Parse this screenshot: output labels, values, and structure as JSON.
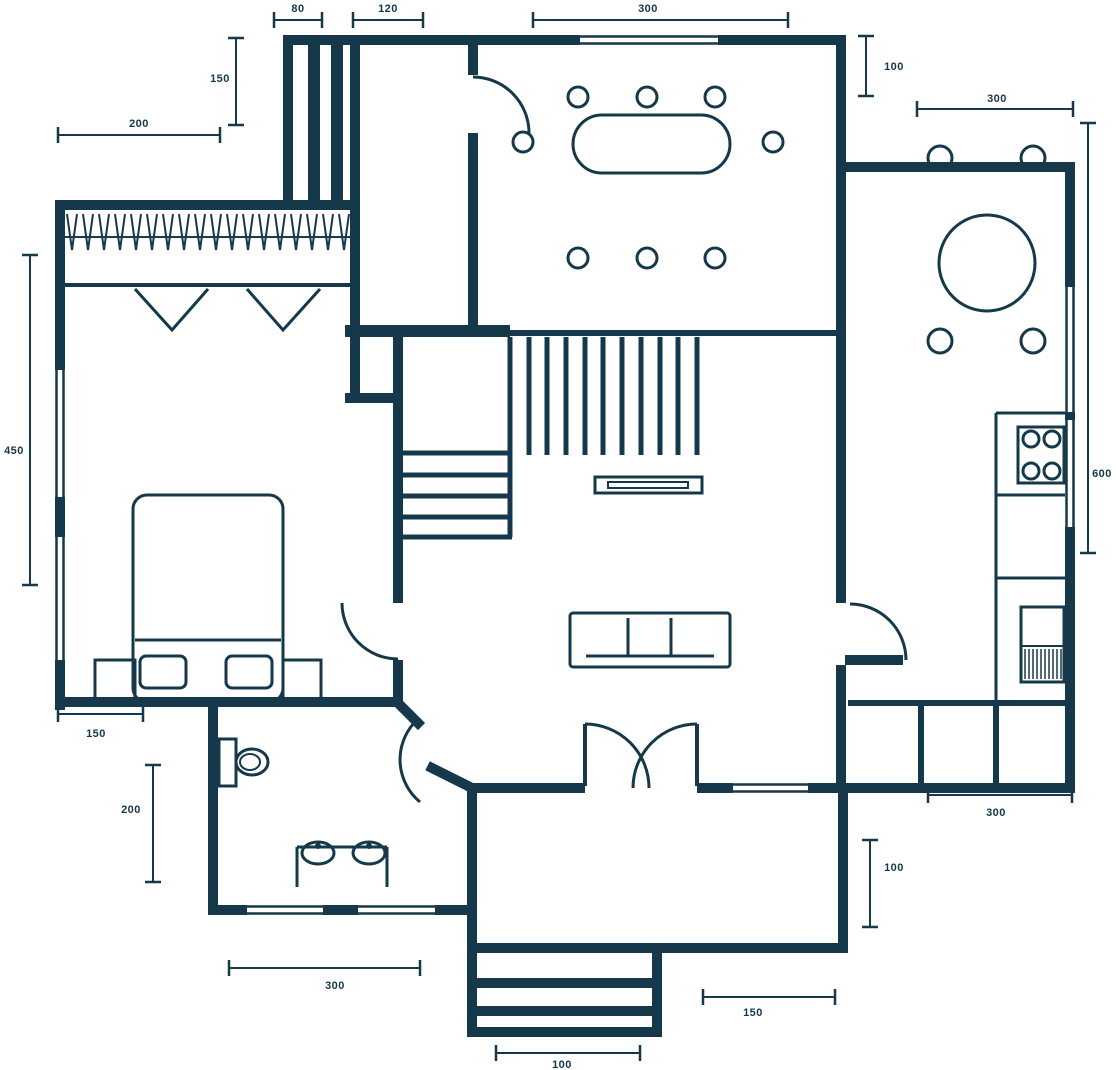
{
  "page": {
    "background": "#ffffff",
    "ink": "#15384a"
  },
  "plan": {
    "width": 1116,
    "height": 1070,
    "furniture": {
      "circles": [
        [
          578,
          97,
          10,
          3
        ],
        [
          647,
          97,
          10,
          3
        ],
        [
          715,
          97,
          10,
          3
        ],
        [
          578,
          258,
          10,
          3
        ],
        [
          647,
          258,
          10,
          3
        ],
        [
          715,
          258,
          10,
          3
        ],
        [
          523,
          142,
          10,
          3
        ],
        [
          773,
          142,
          10,
          3
        ],
        [
          940,
          158,
          12,
          3
        ],
        [
          1033,
          158,
          12,
          3
        ],
        [
          940,
          341,
          12,
          3
        ],
        [
          1033,
          341,
          12,
          3
        ],
        [
          987,
          263,
          48,
          3
        ],
        [
          1031,
          439,
          8,
          3
        ],
        [
          1052,
          439,
          8,
          3
        ],
        [
          1031,
          471,
          8,
          3
        ],
        [
          1052,
          471,
          8,
          3
        ]
      ],
      "dots": [
        [
          318,
          846,
          3
        ],
        [
          369,
          846,
          3
        ]
      ],
      "ellipses": [
        [
          252,
          762,
          16,
          13,
          3
        ],
        [
          250,
          762,
          10,
          8,
          2
        ],
        [
          318,
          853,
          16,
          11,
          3
        ],
        [
          369,
          853,
          16,
          11,
          3
        ]
      ],
      "rects": [
        [
          133,
          495,
          150,
          207,
          14,
          3
        ],
        [
          140,
          656,
          46,
          32,
          6,
          3
        ],
        [
          226,
          656,
          46,
          32,
          6,
          3
        ],
        [
          95,
          660,
          40,
          42,
          0,
          3
        ],
        [
          283,
          660,
          38,
          42,
          0,
          3
        ],
        [
          570,
          613,
          160,
          54,
          3,
          3
        ],
        [
          595,
          477,
          107,
          16,
          0,
          3
        ],
        [
          608,
          482,
          80,
          6,
          0,
          2
        ],
        [
          573,
          115,
          157,
          58,
          29,
          3
        ],
        [
          1018,
          427,
          46,
          56,
          0,
          3
        ],
        [
          1021,
          607,
          43,
          75,
          0,
          3
        ],
        [
          219,
          739,
          17,
          47,
          0,
          3
        ]
      ],
      "lines": [
        [
          135,
          640,
          281,
          640,
          3
        ],
        [
          586,
          656,
          714,
          656,
          3
        ],
        [
          628,
          618,
          628,
          656,
          3
        ],
        [
          671,
          618,
          671,
          656,
          3
        ],
        [
          63,
          285,
          350,
          285,
          4
        ],
        [
          63,
          237,
          350,
          237,
          2
        ],
        [
          510,
          333,
          845,
          333,
          6
        ],
        [
          510,
          337,
          510,
          455,
          5
        ],
        [
          529,
          337,
          529,
          455,
          5
        ],
        [
          547,
          337,
          547,
          455,
          5
        ],
        [
          566,
          337,
          566,
          455,
          5
        ],
        [
          585,
          337,
          585,
          455,
          5
        ],
        [
          603,
          337,
          603,
          455,
          5
        ],
        [
          622,
          337,
          622,
          455,
          5
        ],
        [
          641,
          337,
          641,
          455,
          5
        ],
        [
          660,
          337,
          660,
          455,
          5
        ],
        [
          678,
          337,
          678,
          455,
          5
        ],
        [
          697,
          337,
          697,
          455,
          5
        ],
        [
          403,
          453,
          512,
          453,
          5
        ],
        [
          403,
          475,
          512,
          475,
          5
        ],
        [
          403,
          496,
          512,
          496,
          5
        ],
        [
          403,
          517,
          512,
          517,
          5
        ],
        [
          403,
          537,
          512,
          537,
          5
        ],
        [
          510,
          453,
          510,
          537,
          5
        ],
        [
          996,
          413,
          996,
          701,
          3
        ],
        [
          996,
          413,
          1065,
          413,
          3
        ],
        [
          996,
          495,
          1065,
          495,
          3
        ],
        [
          996,
          578,
          1065,
          578,
          3
        ],
        [
          1021,
          646,
          1064,
          646,
          2
        ],
        [
          1025,
          649,
          1025,
          679,
          1.5
        ],
        [
          1029,
          649,
          1029,
          679,
          1.5
        ],
        [
          1033,
          649,
          1033,
          679,
          1.5
        ],
        [
          1037,
          649,
          1037,
          679,
          1.5
        ],
        [
          1041,
          649,
          1041,
          679,
          1.5
        ],
        [
          1045,
          649,
          1045,
          679,
          1.5
        ],
        [
          1049,
          649,
          1049,
          679,
          1.5
        ],
        [
          1053,
          649,
          1053,
          679,
          1.5
        ],
        [
          1057,
          649,
          1057,
          679,
          1.5
        ],
        [
          1061,
          649,
          1061,
          679,
          1.5
        ],
        [
          297,
          847,
          297,
          887,
          3
        ],
        [
          387,
          847,
          387,
          887,
          3
        ],
        [
          297,
          847,
          387,
          847,
          3
        ],
        [
          477,
          983,
          652,
          983,
          10
        ],
        [
          477,
          1011,
          652,
          1011,
          10
        ],
        [
          585,
          724,
          585,
          786,
          4
        ],
        [
          697,
          724,
          697,
          786,
          4
        ]
      ],
      "paths": [
        [
          "M67,214 L72,250 L77,214 M83,214 L88,250 L93,214 M99,214 L104,250 L109,214 M115,214 L120,250 L125,214 M131,214 L136,250 L141,214 M147,214 L152,250 L157,214 M163,214 L168,250 L173,214 M179,214 L184,250 L189,214 M195,214 L200,250 L205,214 M211,214 L216,250 L221,214 M227,214 L232,250 L237,214 M243,214 L248,250 L253,214 M259,214 L264,250 L269,214 M275,214 L280,250 L285,214 M291,214 L296,250 L301,214 M307,214 L312,250 L317,214 M323,214 L328,250 L333,214 M339,214 L344,250 L349,214",
          2
        ],
        [
          "M135,289 L172,330 L208,289 M247,289 L283,330 L320,289",
          3
        ]
      ]
    },
    "windows": [
      [
        "h",
        580,
        40,
        138
      ],
      [
        "h",
        247,
        910,
        76
      ],
      [
        "h",
        358,
        910,
        77
      ],
      [
        "h",
        733,
        788,
        75
      ],
      [
        "v",
        60,
        370,
        127
      ],
      [
        "v",
        60,
        537,
        123
      ],
      [
        "v",
        1070,
        287,
        125
      ],
      [
        "v",
        1070,
        420,
        107
      ]
    ],
    "walls": [
      [
        283,
        35,
        297,
        10
      ],
      [
        718,
        35,
        127,
        10
      ],
      [
        283,
        35,
        10,
        165
      ],
      [
        308,
        45,
        12,
        155
      ],
      [
        331,
        45,
        12,
        155
      ],
      [
        350,
        45,
        10,
        352
      ],
      [
        55,
        200,
        305,
        10
      ],
      [
        55,
        200,
        10,
        170
      ],
      [
        55,
        497,
        10,
        40
      ],
      [
        55,
        660,
        10,
        50
      ],
      [
        468,
        35,
        10,
        40
      ],
      [
        468,
        133,
        10,
        197
      ],
      [
        345,
        325,
        165,
        12
      ],
      [
        345,
        393,
        58,
        10
      ],
      [
        393,
        330,
        10,
        273
      ],
      [
        393,
        660,
        10,
        40
      ],
      [
        55,
        697,
        348,
        10
      ],
      [
        208,
        702,
        10,
        213
      ],
      [
        208,
        905,
        39,
        10
      ],
      [
        323,
        905,
        35,
        10
      ],
      [
        435,
        905,
        42,
        10
      ],
      [
        467,
        783,
        10,
        254
      ],
      [
        467,
        783,
        118,
        10
      ],
      [
        697,
        783,
        36,
        10
      ],
      [
        808,
        783,
        40,
        10
      ],
      [
        838,
        783,
        10,
        170
      ],
      [
        467,
        943,
        381,
        10
      ],
      [
        836,
        35,
        10,
        568
      ],
      [
        845,
        655,
        58,
        10
      ],
      [
        836,
        665,
        10,
        128
      ],
      [
        846,
        162,
        229,
        10
      ],
      [
        1065,
        162,
        10,
        125
      ],
      [
        1065,
        412,
        10,
        8
      ],
      [
        1065,
        527,
        10,
        266
      ],
      [
        848,
        783,
        227,
        10
      ],
      [
        848,
        700,
        224,
        6
      ],
      [
        918,
        706,
        6,
        77
      ],
      [
        993,
        706,
        6,
        77
      ],
      [
        652,
        953,
        10,
        84
      ],
      [
        467,
        1027,
        195,
        10
      ]
    ],
    "diagonal_walls": [
      [
        397,
        702,
        418,
        723
      ],
      [
        432,
        768,
        470,
        787
      ]
    ],
    "door_arcs": [
      "M473,77 A56,56 0 0 1 529,133",
      "M342,603 A56,56 0 0 0 398,659",
      "M414,723 A55,55 0 0 0 420,802",
      "M850,604 A56,56 0 0 1 906,660",
      "M585,724 A64,64 0 0 1 649,788",
      "M697,724 A64,64 0 0 0 633,788"
    ],
    "dimensions": [
      [
        "80",
        274,
        20,
        322,
        20,
        298,
        12
      ],
      [
        "120",
        353,
        20,
        423,
        20,
        388,
        12
      ],
      [
        "300",
        533,
        20,
        788,
        20,
        648,
        12
      ],
      [
        "150",
        236,
        38,
        236,
        125,
        220,
        82
      ],
      [
        "200",
        58,
        135,
        220,
        135,
        139,
        127
      ],
      [
        "450",
        30,
        255,
        30,
        585,
        14,
        454
      ],
      [
        "150",
        58,
        714,
        143,
        714,
        96,
        737
      ],
      [
        "200",
        153,
        765,
        153,
        882,
        131,
        813
      ],
      [
        "300",
        229,
        968,
        420,
        968,
        335,
        989
      ],
      [
        "100",
        496,
        1053,
        640,
        1053,
        562,
        1068
      ],
      [
        "150",
        703,
        997,
        835,
        997,
        753,
        1016
      ],
      [
        "100",
        870,
        840,
        870,
        927,
        894,
        871
      ],
      [
        "300",
        928,
        795,
        1072,
        795,
        996,
        816
      ],
      [
        "100",
        866,
        36,
        866,
        96,
        894,
        70
      ],
      [
        "300",
        917,
        109,
        1073,
        109,
        997,
        102
      ],
      [
        "600",
        1088,
        123,
        1088,
        553,
        1102,
        477
      ]
    ]
  }
}
